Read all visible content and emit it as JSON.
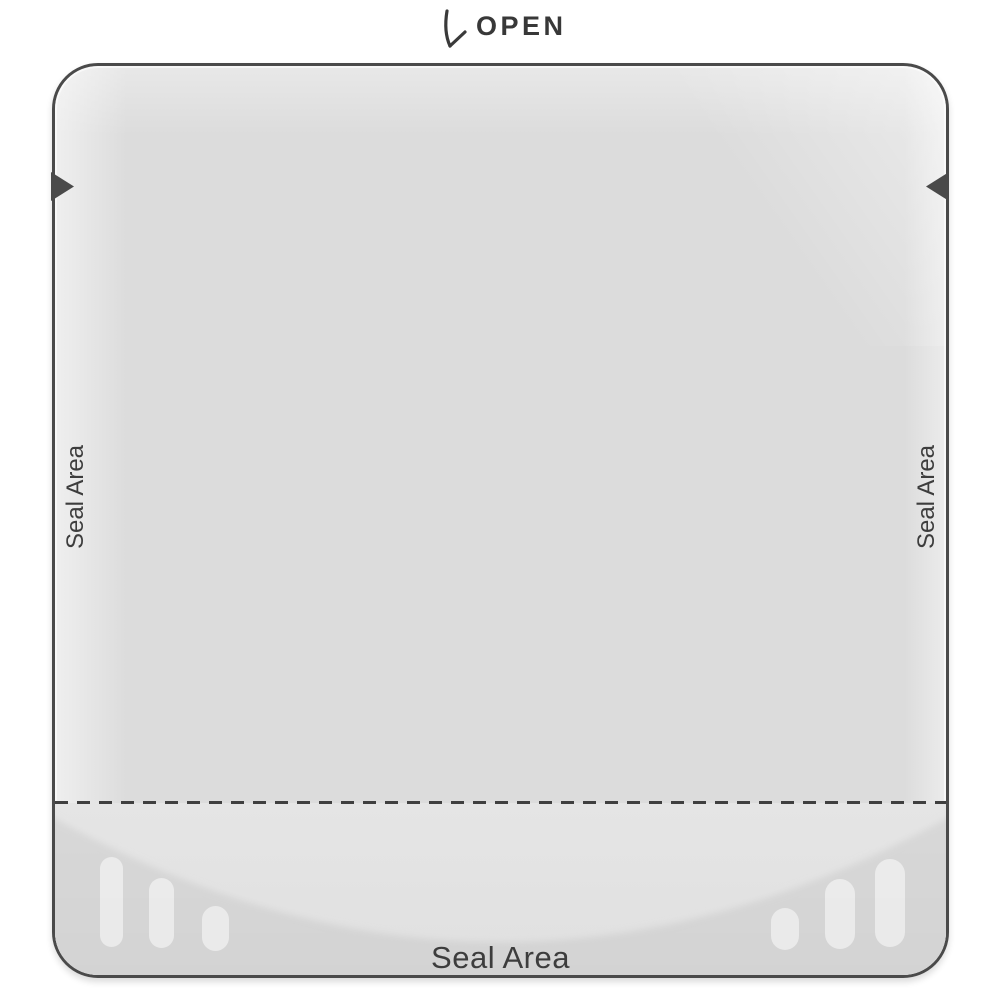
{
  "header": {
    "open_label": "OPEN",
    "open_arrow_icon": "↓"
  },
  "pouch": {
    "seal_area_left": "Seal Area",
    "seal_area_right": "Seal Area",
    "seal_area_bottom": "Seal Area"
  },
  "colors": {
    "background": "#ffffff",
    "outline": "#4a4a4a",
    "body": "#dcdcdc",
    "body_highlight": "#f0f0f0",
    "gusset_light": "#e5e5e5",
    "gusset_dark": "#d3d3d3",
    "emboss_pill": "rgba(255,255,255,0.5)",
    "label_text": "#3d3d3d",
    "notch": "#4a4a4a",
    "dash_line": "#3f3f3f"
  }
}
